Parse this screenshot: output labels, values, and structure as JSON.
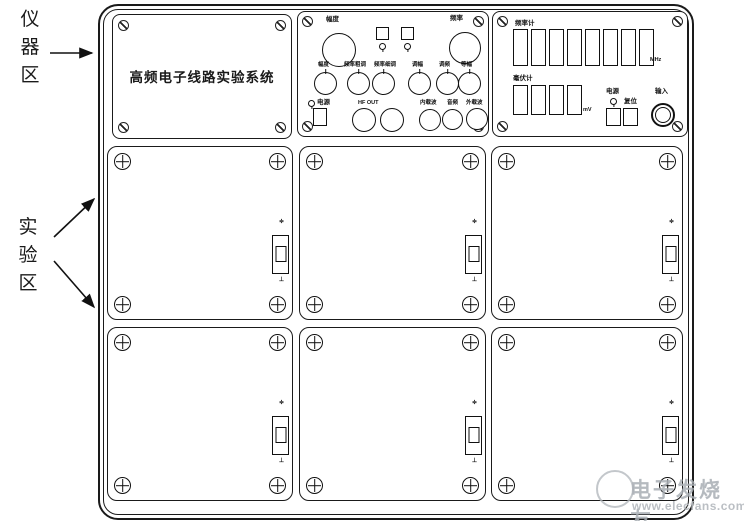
{
  "annotations": {
    "instrument_area_chars": [
      "仪",
      "器",
      "区"
    ],
    "experiment_area_chars": [
      "实",
      "验",
      "区"
    ]
  },
  "instrument_panels": {
    "title_panel": {
      "title": "高频电子线路实验系统"
    },
    "signal_source_panel": {
      "big_knob_left_label": "幅度",
      "big_knob_right_label": "频率",
      "mid_knob_labels": [
        "幅度",
        "频率粗调",
        "频率细调",
        "调幅",
        "调频",
        "等幅"
      ],
      "power_label": "电源",
      "hf_out_label": "HF OUT",
      "jack_labels": [
        "内载波",
        "音频",
        "外载波"
      ]
    },
    "counter_panel": {
      "freq_label": "频率计",
      "freq_unit": "MHz",
      "mv_label": "毫伏计",
      "mv_unit": "mV",
      "power_label": "电源",
      "reset_label": "复位",
      "input_label": "输入"
    }
  },
  "experiment_panels": {
    "count": 6,
    "switch_top_mark": "≑",
    "switch_bottom_mark": "⊥"
  },
  "watermark": {
    "brand": "电子发烧友",
    "url": "www.elecfans.com"
  },
  "colors": {
    "line": "#1a1a1a",
    "watermark": "#a9aeb4"
  }
}
